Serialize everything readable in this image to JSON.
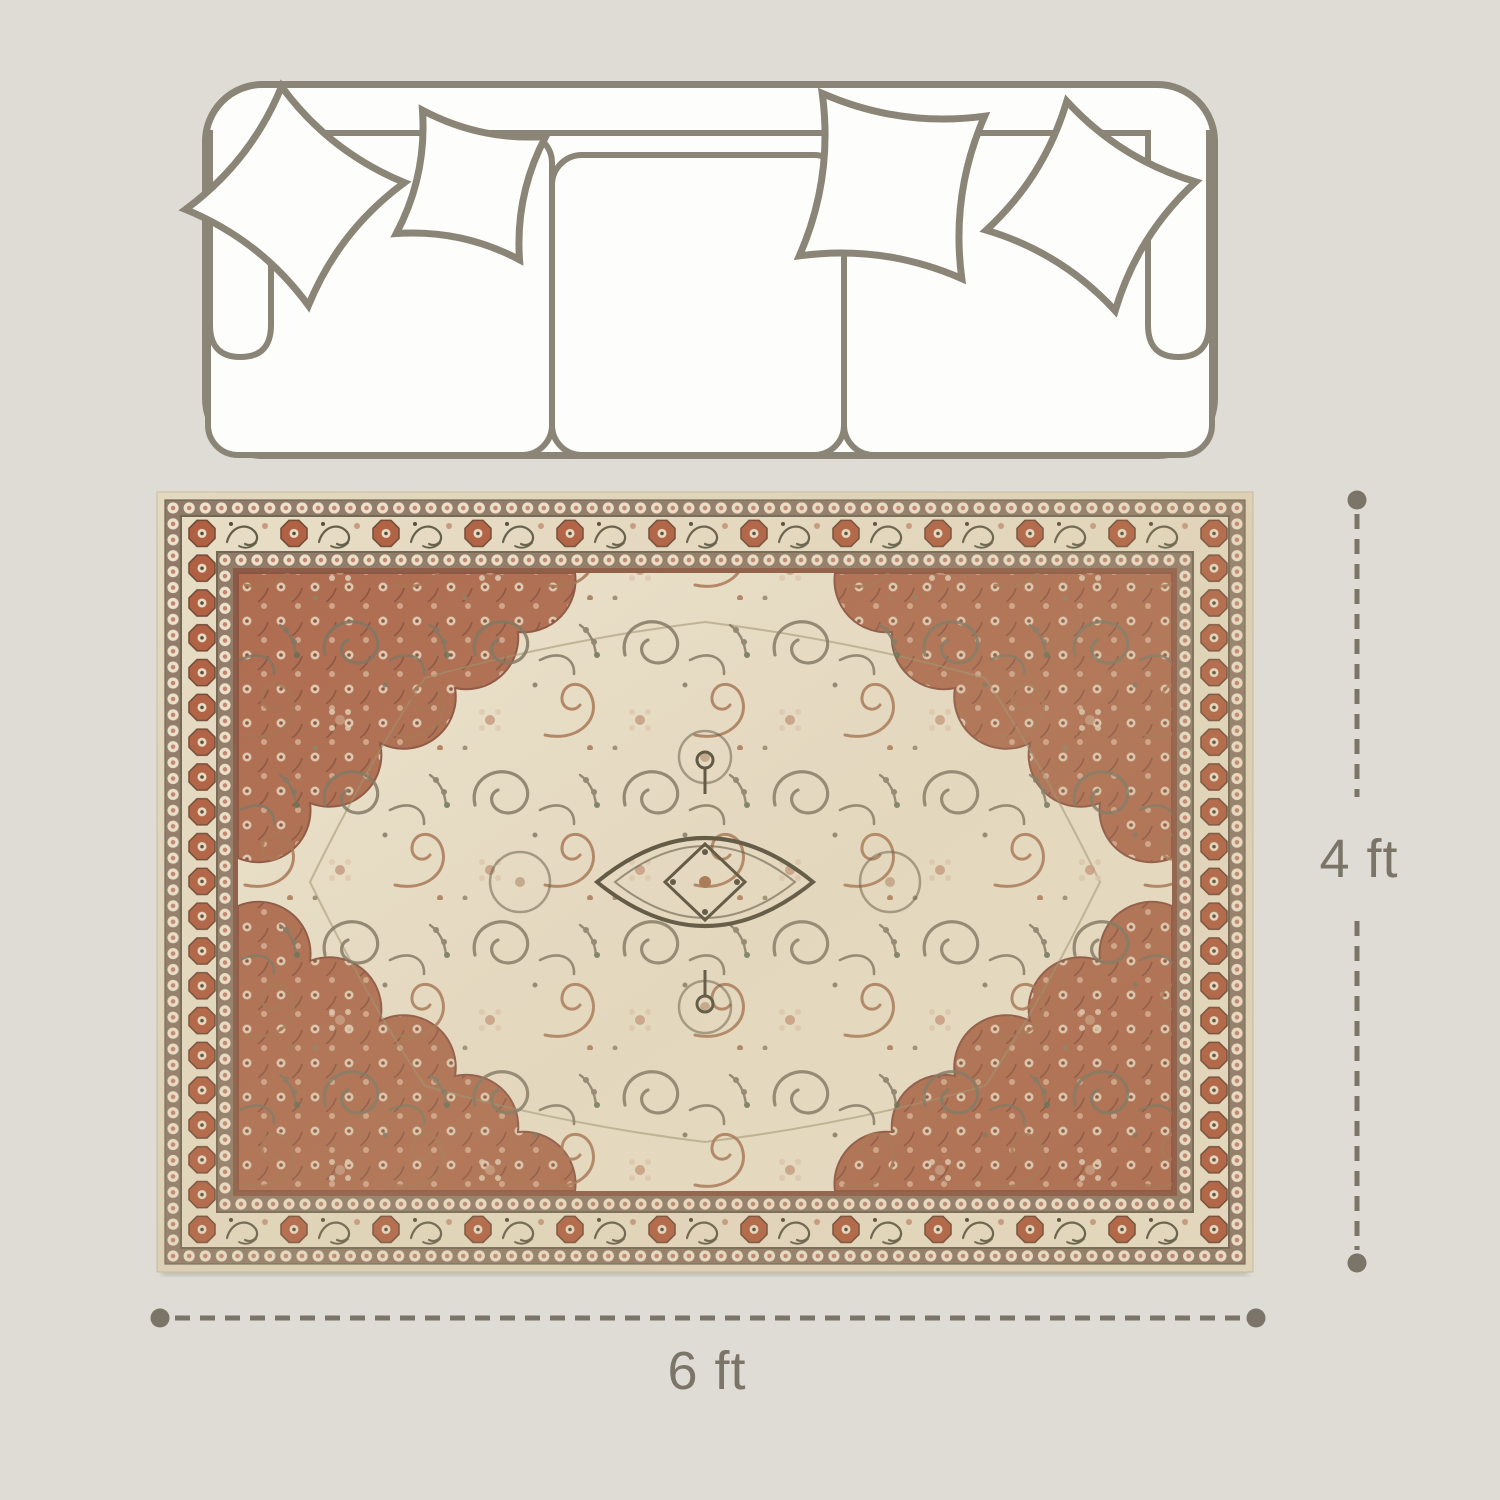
{
  "diagram": {
    "height_label": "4 ft",
    "width_label": "6 ft"
  },
  "icons": {
    "sofa": "sofa-top-view-outline",
    "pillows": "four-point-star-pillow-outline",
    "rug": "vintage-persian-medallion-rug",
    "dimension_marker": "round-dot-with-dashed-line"
  },
  "colors": {
    "background": "#dedcd5",
    "dimension": "#7b7468",
    "sofa_outline": "#8a8577",
    "sofa_fill": "#fdfdfb",
    "rug_selvage": "#e3d9c0",
    "rug_guard_ground": "#8f7a68",
    "rug_guard_dot": "#eee3cf",
    "rug_guard_dot_center": "#c2846c",
    "rug_border_ground": "#e8dec6",
    "rug_octagon": "#b05f41",
    "rug_scroll": "#5f5b47",
    "rug_frame_line": "#6e6553",
    "rug_rust_line": "#8a5843",
    "rug_field": "#ece3cd",
    "rug_spandrel": "#ae6a4e",
    "rug_vine_olive": "#7a7260",
    "rug_vine_rust": "#a4714f",
    "rug_flower_pink": "#c79a80",
    "rug_medallion_line": "#4e4938"
  }
}
